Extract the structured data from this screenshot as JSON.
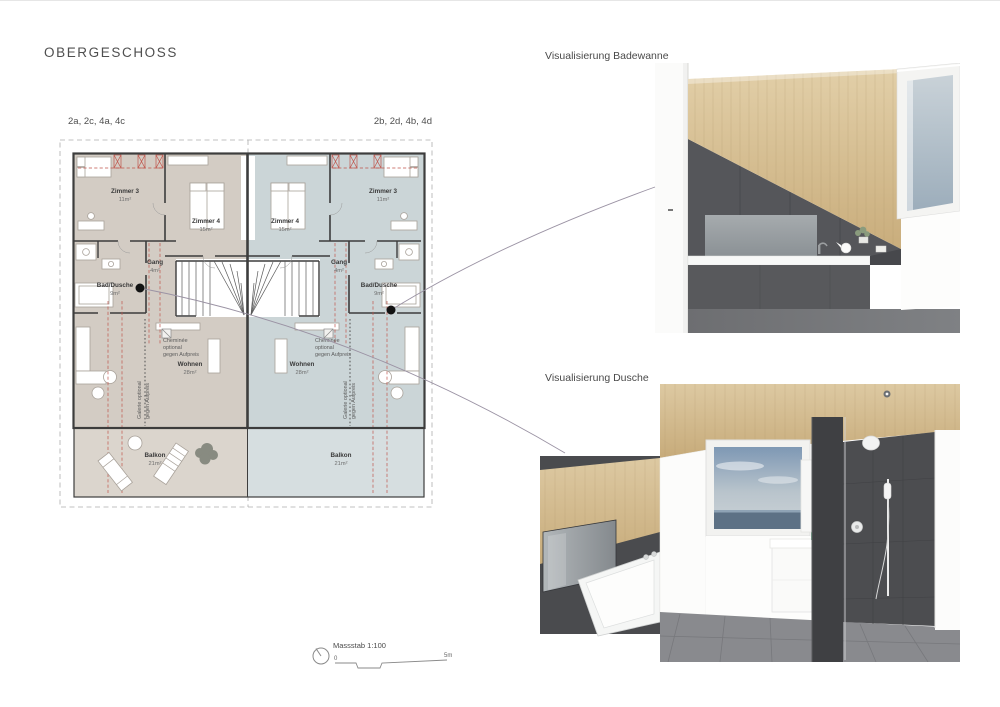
{
  "page": {
    "title": "OBERGESCHOSS"
  },
  "plan": {
    "unit_left": {
      "label": "2a, 2c, 4a, 4c",
      "rooms": {
        "zimmer3": {
          "name": "Zimmer 3",
          "area": "11m²"
        },
        "zimmer4": {
          "name": "Zimmer 4",
          "area": "15m²"
        },
        "gang": {
          "name": "Gang",
          "area": "4m²"
        },
        "bad": {
          "name": "Bad/Dusche",
          "area": "9m²"
        },
        "wohnen": {
          "name": "Wohnen",
          "area": "28m²"
        },
        "balkon": {
          "name": "Balkon",
          "area": "21m²"
        }
      },
      "cheminee_lines": [
        "Cheminée",
        "optional",
        "gegen Aufpreis"
      ],
      "galerie_lines": [
        "Galerie optional",
        "gegen Aufpreis"
      ]
    },
    "unit_right": {
      "label": "2b, 2d, 4b, 4d",
      "rooms": {
        "zimmer3": {
          "name": "Zimmer 3",
          "area": "11m²"
        },
        "zimmer4": {
          "name": "Zimmer 4",
          "area": "15m²"
        },
        "gang": {
          "name": "Gang",
          "area": "4m²"
        },
        "bad": {
          "name": "Bad/Dusche",
          "area": "9m²"
        },
        "wohnen": {
          "name": "Wohnen",
          "area": "28m²"
        },
        "balkon": {
          "name": "Balkon",
          "area": "21m²"
        }
      },
      "cheminee_lines": [
        "Cheminée",
        "optional",
        "gegen Aufpreis"
      ],
      "galerie_lines": [
        "Galerie optional",
        "gegen Aufpreis"
      ]
    }
  },
  "visualizations": {
    "badewanne": {
      "title": "Visualisierung Badewanne"
    },
    "dusche": {
      "title": "Visualisierung Dusche"
    }
  },
  "scalebar": {
    "label": "Massstab 1:100",
    "zero": "0",
    "five": "5m"
  },
  "colors": {
    "unit_left_fill": "#d3ccc4",
    "unit_left_balcony": "#dbd5cd",
    "unit_right_fill": "#cbd5d7",
    "unit_right_balcony": "#d6dee0",
    "roof_line_red": "#c0544b",
    "wood": "#d6c29a",
    "tile_dark": "#4c4d50",
    "leader_line": "#9b93a4"
  }
}
